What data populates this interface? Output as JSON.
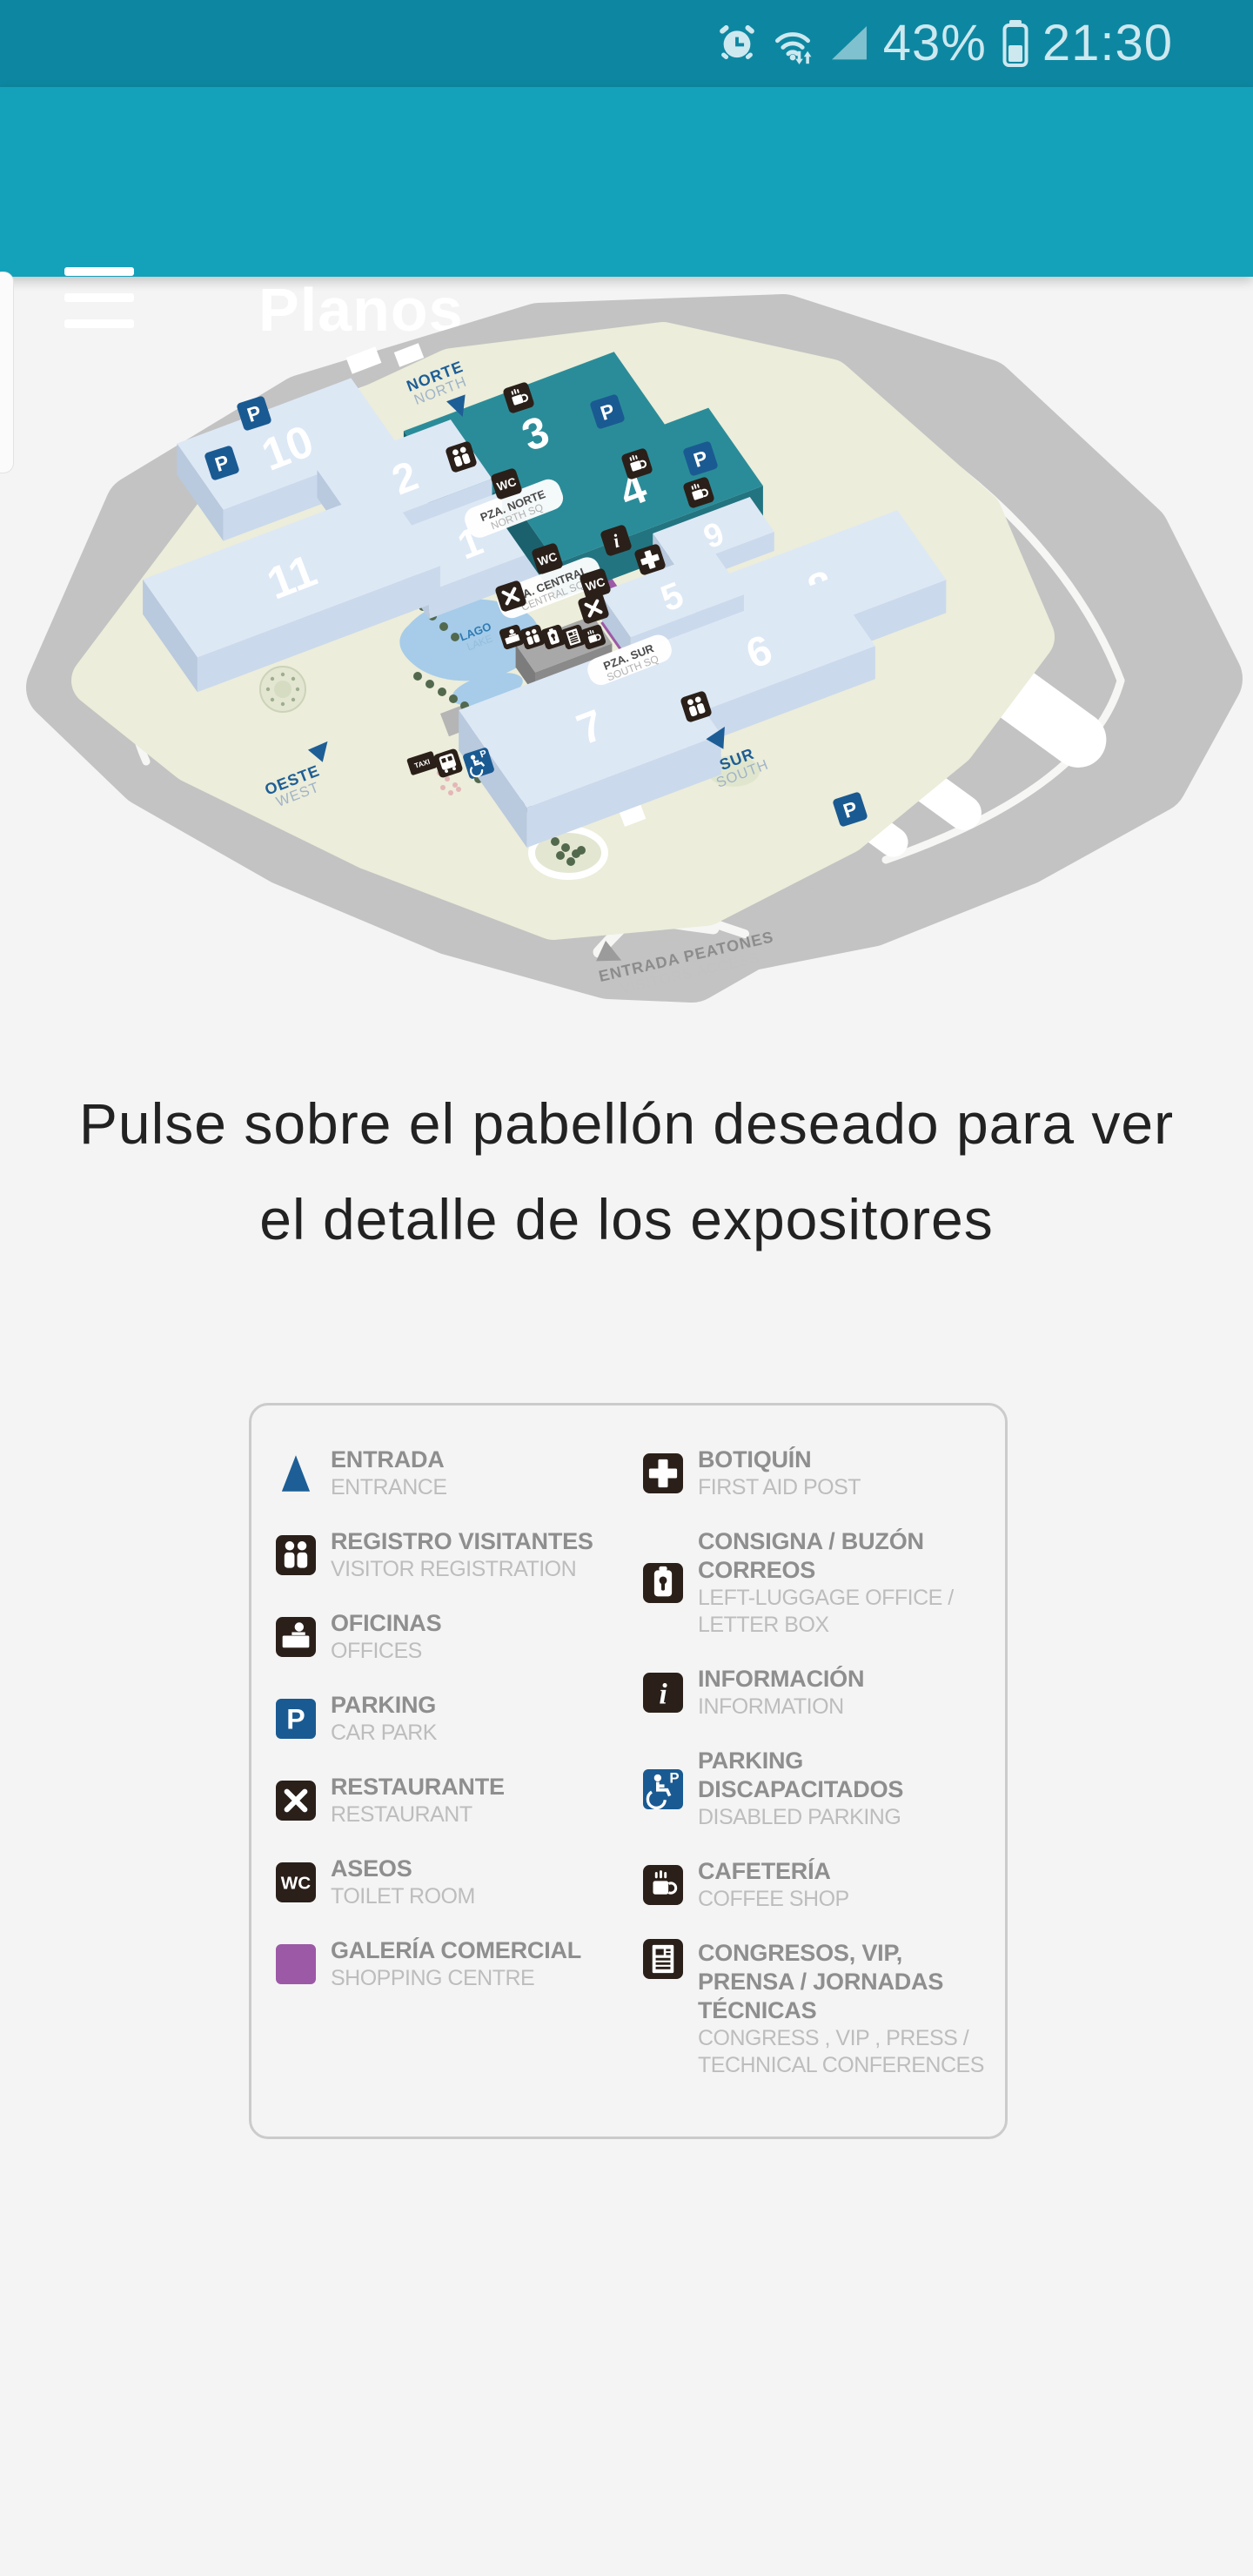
{
  "status_bar": {
    "alarm_icon": "alarm-clock",
    "wifi_icon": "wifi-updown",
    "signal_icon": "cellular-signal",
    "battery_icon": "battery",
    "battery_percent": "43%",
    "time": "21:30"
  },
  "app_bar": {
    "title": "Planos",
    "menu_icon": "hamburger"
  },
  "instruction": {
    "text": "Pulse sobre el pabellón deseado para ver el detalle de los expositores"
  },
  "map": {
    "pavilions": [
      {
        "id": "10",
        "highlighted": false
      },
      {
        "id": "3",
        "highlighted": true
      },
      {
        "id": "2",
        "highlighted": false
      },
      {
        "id": "1",
        "highlighted": false
      },
      {
        "id": "11",
        "highlighted": false
      },
      {
        "id": "4",
        "highlighted": true
      },
      {
        "id": "9",
        "highlighted": false
      },
      {
        "id": "8",
        "highlighted": false
      },
      {
        "id": "5",
        "highlighted": false
      },
      {
        "id": "6",
        "highlighted": false
      },
      {
        "id": "7",
        "highlighted": false
      }
    ],
    "entrances": {
      "north": {
        "es": "NORTE",
        "en": "NORTH"
      },
      "south": {
        "es": "SUR",
        "en": "SOUTH"
      },
      "west": {
        "es": "OESTE",
        "en": "WEST"
      }
    },
    "plazas": {
      "north": {
        "es": "PZA. NORTE",
        "en": "NORTH SQ"
      },
      "central": {
        "es": "PZA. CENTRAL",
        "en": "CENTRAL SQ"
      },
      "south": {
        "es": "PZA. SUR",
        "en": "SOUTH SQ"
      }
    },
    "lake": {
      "es": "LAGO",
      "en": "LAKE"
    },
    "pedestrian_entrance": {
      "es": "ENTRADA PEATONES",
      "en": "VISITORS ACCESS"
    },
    "colors": {
      "highlight_top": "#2b8c99",
      "highlight_front": "#227480",
      "highlight_side": "#1b616d",
      "pavilion_top": "#dde8f5",
      "pavilion_front": "#cbd9ec",
      "pavilion_side": "#b9c9de",
      "parking_blue": "#1a5a92",
      "icon_dark": "#2a2019",
      "gallery_purple": "#9c59a6",
      "lake_blue": "#a6cce9",
      "ground": "#ecedda",
      "road_gray": "#c3c3c3",
      "entrance_blue": "#1d5e96",
      "tree_green": "#52694e"
    }
  },
  "legend": {
    "columns": [
      [
        {
          "icon": "entrance-triangle",
          "es": "ENTRADA",
          "en": "ENTRANCE"
        },
        {
          "icon": "visitor-registration",
          "es": "REGISTRO VISITANTES",
          "en": "VISITOR REGISTRATION"
        },
        {
          "icon": "offices",
          "es": "OFICINAS",
          "en": "OFFICES"
        },
        {
          "icon": "parking",
          "es": "PARKING",
          "en": "CAR PARK"
        },
        {
          "icon": "restaurant",
          "es": "RESTAURANTE",
          "en": "RESTAURANT"
        },
        {
          "icon": "toilets",
          "es": "ASEOS",
          "en": "TOILET ROOM"
        },
        {
          "icon": "shopping-gallery",
          "es": "GALERÍA COMERCIAL",
          "en": "SHOPPING CENTRE"
        }
      ],
      [
        {
          "icon": "first-aid",
          "es": "BOTIQUÍN",
          "en": "FIRST AID POST"
        },
        {
          "icon": "left-luggage",
          "es": "CONSIGNA / BUZÓN CORREOS",
          "en": "LEFT-LUGGAGE OFFICE / LETTER BOX"
        },
        {
          "icon": "information",
          "es": "INFORMACIÓN",
          "en": "INFORMATION"
        },
        {
          "icon": "disabled-parking",
          "es": "PARKING DISCAPACITADOS",
          "en": "DISABLED PARKING"
        },
        {
          "icon": "coffee-shop",
          "es": "CAFETERÍA",
          "en": "COFFEE SHOP"
        },
        {
          "icon": "congress",
          "es": "CONGRESOS, VIP, PRENSA / JORNADAS TÉCNICAS",
          "en": "CONGRESS , VIP , PRESS / TECHNICAL CONFERENCES"
        }
      ]
    ]
  }
}
